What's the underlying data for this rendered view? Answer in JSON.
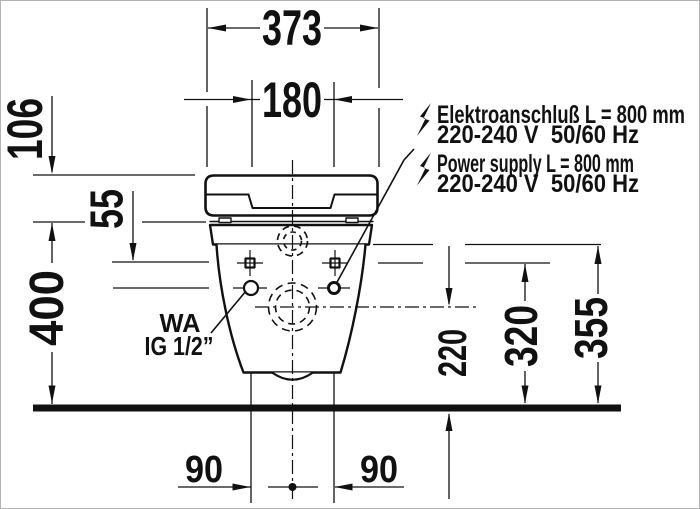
{
  "drawing": {
    "dimensions": {
      "overall_width": "373",
      "fixing_centers_width": "180",
      "cover_height": "106",
      "rim_offset": "55",
      "rim_height": "400",
      "outlet_height": "220",
      "fixing_height": "320",
      "connection_height": "355",
      "outlet_offset_left": "90",
      "outlet_offset_right": "90"
    },
    "labels": {
      "electro_de_1": "Elektroanschluß L = 800 mm",
      "electro_de_2": "220-240 V  50/60 Hz",
      "electro_en_1": "Power supply L = 800 mm",
      "electro_en_2": "220-240 V  50/60 Hz",
      "water_abbr": "WA",
      "water_thread": "IG 1/2”"
    },
    "colors": {
      "ink": "#111111",
      "background": "#ffffff",
      "frame": "#b3b3b3"
    }
  }
}
